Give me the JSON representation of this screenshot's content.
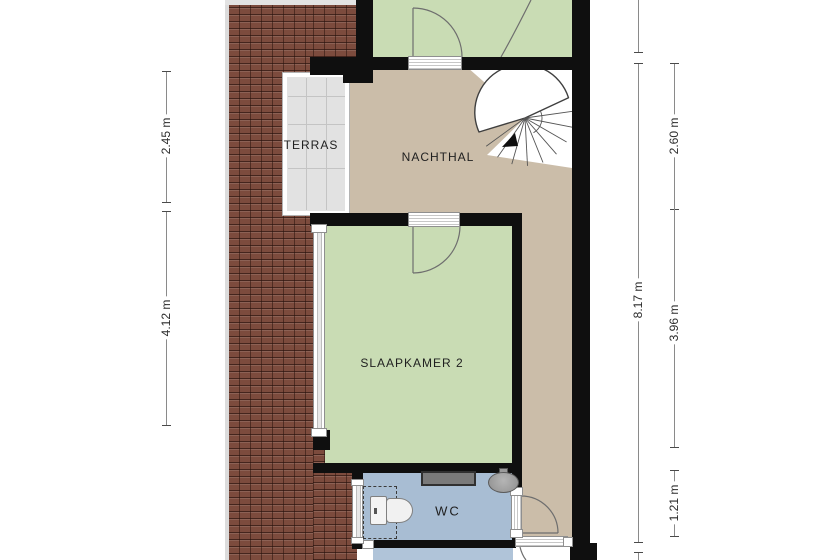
{
  "rooms": {
    "terras": {
      "label": "TERRAS"
    },
    "nachthal": {
      "label": "NACHTHAL"
    },
    "slaapkamer": {
      "label": "SLAAPKAMER 2"
    },
    "wc": {
      "label": "WC"
    }
  },
  "dims": {
    "left": [
      {
        "label": "2.45 m"
      },
      {
        "label": "4.12 m"
      }
    ],
    "right": [
      {
        "label": "8.17 m"
      }
    ],
    "inner": [
      {
        "label": "2.60 m"
      },
      {
        "label": "3.96 m"
      },
      {
        "label": "1.21 m"
      }
    ]
  },
  "colors": {
    "wall": "#0f0f0f",
    "tan": "#cbbda9",
    "green": "#c9dcb4",
    "blue": "#a8bdd3",
    "blue2": "#b0c4d9",
    "terras": "#e2e2e2",
    "brick": "#7c4b3d",
    "dim": "#8a8a8a",
    "text": "#1f1f1f"
  }
}
